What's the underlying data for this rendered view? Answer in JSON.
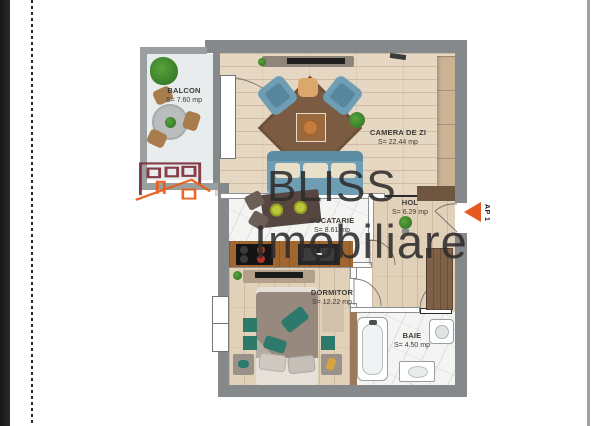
{
  "watermark": {
    "brand_line1": "BLISS",
    "brand_line2": "Imobiliare"
  },
  "entrance": {
    "label": "AP 1"
  },
  "rooms": [
    {
      "name": "BALCON",
      "area": "S= 7.60 mp"
    },
    {
      "name": "CAMERA DE ZI",
      "area": "S= 22.44 mp"
    },
    {
      "name": "HOL",
      "area": "S= 6.29 mp"
    },
    {
      "name": "BUCATARIE",
      "area": "S= 8.61 mp"
    },
    {
      "name": "DORMITOR",
      "area": "S= 12.22 mp"
    },
    {
      "name": "BAIE",
      "area": "S= 4.50 mp"
    }
  ],
  "colors": {
    "wall_gray": "#85898b",
    "balcony_wall_gray": "#9aa0a0",
    "wood_floor": "#e6d7c2",
    "marble_floor": "#f4f4f2",
    "sofa_blue": "#6f9db4",
    "rug_brown": "#7b5b42",
    "counter_wood": "#a0662f",
    "teal_accent": "#2d7a6d",
    "logo_maroon": "#7d2f3b",
    "logo_orange": "#ea5b17",
    "arrow_orange": "#e8571b",
    "watermark_text": "#2e2c2b"
  }
}
